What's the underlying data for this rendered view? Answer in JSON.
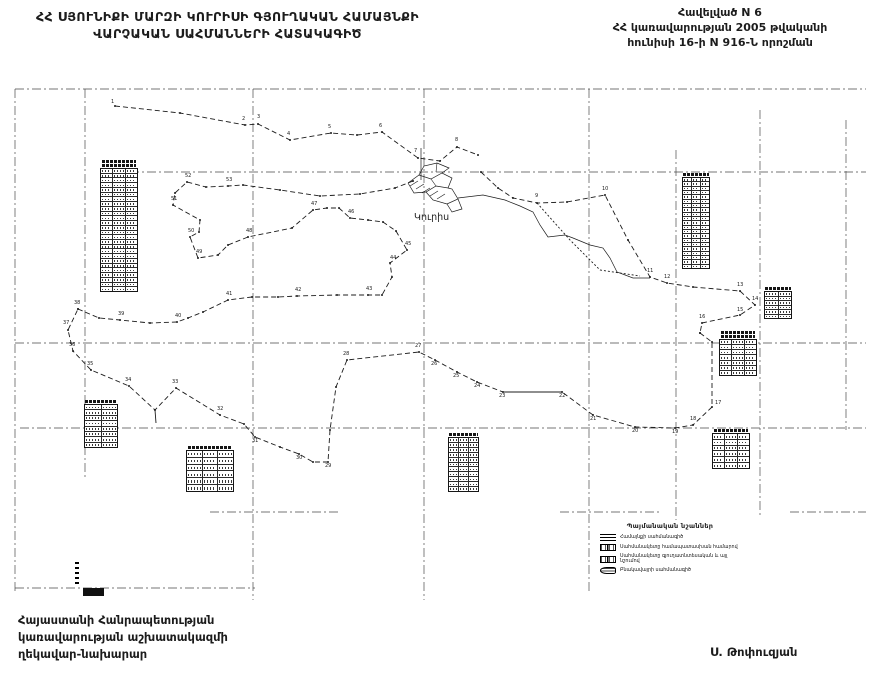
{
  "header": {
    "title_line1": "ՀՀ ՍՅՈՒՆԻՔԻ ՄԱՐԶԻ ԿՈՒՐԻՍԻ ԳՅՈՒՂԱԿԱՆ ՀԱՄԱՅՆՔԻ",
    "title_line2": "ՎԱՐՉԱԿԱՆ ՍԱՀՄԱՆՆԵՐԻ ՀԱՏԱԿԱԳԻԾ",
    "appendix_line1": "Հավելված N 6",
    "appendix_line2": "ՀՀ կառավարության 2005 թվականի",
    "appendix_line3": "հունիսի 16-ի N 916-Ն որոշման"
  },
  "footer": {
    "left_line1": "Հայաստանի Հանրապետության",
    "left_line2": "կառավարության աշխատակազմի",
    "left_line3": "ղեկավար-նախարար",
    "signature": "Ս. Թոփուզյան"
  },
  "legend": {
    "title": "Պայմանական նշաններ",
    "items": [
      {
        "symbol": "community-boundary-line-symbol",
        "label": "Համայնքի սահմանագիծ"
      },
      {
        "symbol": "boundary-point-number-symbol",
        "label": "Սահմանակետը համապատասխան համարով"
      },
      {
        "symbol": "boundary-point-agri-symbol",
        "label": "Սահմանակետը գյուղատնտեսական և այլ նշումով"
      },
      {
        "symbol": "settlement-boundary-symbol",
        "label": "Բնակավայրի սահմանագիծ"
      }
    ]
  },
  "map": {
    "settlement_label": "Կուրիս",
    "colors": {
      "ink": "#1c1c1c",
      "grid": "#4a4a4a",
      "paper": "#ffffff"
    },
    "grid": {
      "h": [
        {
          "y": 89,
          "x1": 15,
          "x2": 866
        },
        {
          "y": 172,
          "x1": 130,
          "x2": 866
        },
        {
          "y": 343,
          "x1": 15,
          "x2": 866
        },
        {
          "y": 428,
          "x1": 20,
          "x2": 866
        },
        {
          "y": 512,
          "x1": 210,
          "x2": 340
        },
        {
          "y": 512,
          "x1": 560,
          "x2": 660
        },
        {
          "y": 512,
          "x1": 790,
          "x2": 866
        },
        {
          "y": 588,
          "x1": 15,
          "x2": 255
        }
      ],
      "v": [
        {
          "x": 15,
          "y1": 89,
          "y2": 592
        },
        {
          "x": 85,
          "y1": 89,
          "y2": 480
        },
        {
          "x": 253,
          "y1": 89,
          "y2": 600
        },
        {
          "x": 424,
          "y1": 89,
          "y2": 600
        },
        {
          "x": 589,
          "y1": 89,
          "y2": 592
        },
        {
          "x": 676,
          "y1": 150,
          "y2": 520
        },
        {
          "x": 760,
          "y1": 110,
          "y2": 515
        },
        {
          "x": 846,
          "y1": 120,
          "y2": 430
        }
      ]
    },
    "paths": [
      {
        "name": "north-boundary",
        "dash": "5 3",
        "marks": true,
        "pts": [
          [
            115,
            106
          ],
          [
            180,
            113
          ],
          [
            245,
            125
          ],
          [
            258,
            124
          ],
          [
            290,
            140
          ],
          [
            331,
            133
          ],
          [
            357,
            135
          ],
          [
            382,
            132
          ],
          [
            418,
            158
          ],
          [
            440,
            161
          ],
          [
            457,
            147
          ],
          [
            478,
            155
          ]
        ]
      },
      {
        "name": "northeast-boundary",
        "dash": "5 3",
        "marks": true,
        "pts": [
          [
            481,
            172
          ],
          [
            498,
            188
          ],
          [
            513,
            198
          ],
          [
            537,
            203
          ],
          [
            567,
            202
          ],
          [
            605,
            195
          ],
          [
            628,
            240
          ],
          [
            650,
            277
          ],
          [
            667,
            283
          ],
          [
            693,
            287
          ],
          [
            740,
            291
          ],
          [
            755,
            305
          ],
          [
            740,
            315
          ],
          [
            702,
            323
          ],
          [
            700,
            333
          ]
        ]
      },
      {
        "name": "stream-line",
        "solid": true,
        "w": 0.7,
        "pts": [
          [
            458,
            198
          ],
          [
            483,
            195
          ],
          [
            505,
            200
          ],
          [
            520,
            206
          ],
          [
            533,
            212
          ],
          [
            540,
            225
          ],
          [
            548,
            237
          ],
          [
            565,
            235
          ],
          [
            573,
            238
          ],
          [
            590,
            245
          ],
          [
            603,
            248
          ],
          [
            610,
            258
          ],
          [
            617,
            272
          ],
          [
            633,
            278
          ],
          [
            650,
            278
          ]
        ]
      },
      {
        "name": "secondary-dashed-line",
        "dash": "2 2",
        "pts": [
          [
            537,
            203
          ],
          [
            570,
            240
          ],
          [
            600,
            270
          ],
          [
            640,
            276
          ]
        ]
      },
      {
        "name": "east-south-boundary",
        "dash": "5 3",
        "marks": true,
        "pts": [
          [
            700,
            333
          ],
          [
            712,
            342
          ],
          [
            712,
            407
          ],
          [
            693,
            425
          ],
          [
            675,
            428
          ],
          [
            635,
            427
          ],
          [
            593,
            415
          ],
          [
            562,
            392
          ],
          [
            503,
            392
          ],
          [
            477,
            382
          ],
          [
            457,
            372
          ],
          [
            435,
            360
          ],
          [
            419,
            352
          ],
          [
            347,
            360
          ],
          [
            336,
            387
          ],
          [
            330,
            430
          ],
          [
            328,
            462
          ],
          [
            313,
            462
          ],
          [
            299,
            454
          ],
          [
            280,
            447
          ],
          [
            255,
            437
          ],
          [
            244,
            424
          ],
          [
            220,
            415
          ],
          [
            176,
            388
          ],
          [
            155,
            410
          ],
          [
            129,
            386
          ],
          [
            91,
            370
          ],
          [
            73,
            351
          ],
          [
            68,
            330
          ],
          [
            78,
            309
          ]
        ]
      },
      {
        "name": "solid-boundary-segment",
        "solid": true,
        "pts": [
          [
            503,
            392
          ],
          [
            562,
            392
          ]
        ]
      },
      {
        "name": "middle-boundary",
        "dash": "5 3",
        "marks": true,
        "pts": [
          [
            78,
            309
          ],
          [
            99,
            318
          ],
          [
            120,
            320
          ],
          [
            150,
            323
          ],
          [
            177,
            322
          ],
          [
            188,
            318
          ],
          [
            203,
            312
          ],
          [
            228,
            300
          ],
          [
            252,
            297
          ],
          [
            278,
            297
          ],
          [
            297,
            296
          ],
          [
            337,
            295
          ],
          [
            368,
            295
          ],
          [
            382,
            295
          ],
          [
            392,
            277
          ],
          [
            390,
            263
          ],
          [
            407,
            250
          ],
          [
            396,
            231
          ],
          [
            383,
            222
          ],
          [
            368,
            220
          ],
          [
            350,
            218
          ],
          [
            339,
            208
          ],
          [
            327,
            208
          ],
          [
            313,
            210
          ],
          [
            292,
            228
          ],
          [
            248,
            237
          ],
          [
            228,
            245
          ],
          [
            218,
            255
          ],
          [
            198,
            258
          ],
          [
            190,
            237
          ],
          [
            199,
            232
          ],
          [
            200,
            220
          ],
          [
            173,
            205
          ],
          [
            175,
            193
          ],
          [
            187,
            182
          ],
          [
            206,
            187
          ],
          [
            228,
            186
          ],
          [
            243,
            185
          ],
          [
            280,
            190
          ],
          [
            320,
            196
          ],
          [
            360,
            194
          ],
          [
            395,
            188
          ],
          [
            413,
            181
          ]
        ]
      },
      {
        "name": "dip-tick",
        "solid": true,
        "pts": [
          [
            155,
            410
          ],
          [
            156,
            423
          ]
        ]
      },
      {
        "name": "settlement-block-a",
        "solid": true,
        "w": 0.7,
        "pts": [
          [
            408,
            183
          ],
          [
            419,
            175
          ],
          [
            431,
            179
          ],
          [
            442,
            173
          ],
          [
            452,
            178
          ],
          [
            448,
            188
          ],
          [
            436,
            186
          ],
          [
            426,
            192
          ],
          [
            414,
            193
          ],
          [
            408,
            183
          ]
        ]
      },
      {
        "name": "settlement-block-b",
        "solid": true,
        "w": 0.7,
        "pts": [
          [
            419,
            175
          ],
          [
            424,
            166
          ],
          [
            437,
            163
          ],
          [
            449,
            168
          ],
          [
            442,
            173
          ]
        ]
      },
      {
        "name": "settlement-block-c",
        "solid": true,
        "w": 0.7,
        "pts": [
          [
            426,
            192
          ],
          [
            433,
            200
          ],
          [
            447,
            204
          ],
          [
            458,
            199
          ],
          [
            452,
            189
          ],
          [
            448,
            188
          ]
        ]
      },
      {
        "name": "settlement-block-d",
        "solid": true,
        "w": 0.7,
        "pts": [
          [
            447,
            204
          ],
          [
            452,
            212
          ],
          [
            462,
            209
          ],
          [
            458,
            199
          ]
        ]
      },
      {
        "name": "settlement-hatch",
        "solid": true,
        "w": 0.6,
        "pts": [
          [
            410,
            186
          ],
          [
            418,
            181
          ]
        ]
      },
      {
        "name": "settlement-hatch",
        "solid": true,
        "w": 0.6,
        "pts": [
          [
            416,
            189
          ],
          [
            424,
            184
          ]
        ]
      },
      {
        "name": "settlement-hatch",
        "solid": true,
        "w": 0.6,
        "pts": [
          [
            422,
            193
          ],
          [
            430,
            188
          ]
        ]
      },
      {
        "name": "settlement-hatch",
        "solid": true,
        "w": 0.6,
        "pts": [
          [
            430,
            196
          ],
          [
            438,
            191
          ]
        ]
      },
      {
        "name": "settlement-hatch",
        "solid": true,
        "w": 0.6,
        "pts": [
          [
            437,
            199
          ],
          [
            445,
            194
          ]
        ]
      },
      {
        "name": "settlement-hatch",
        "solid": true,
        "w": 0.6,
        "pts": [
          [
            431,
            179
          ],
          [
            436,
            186
          ]
        ]
      },
      {
        "name": "settlement-hatch",
        "solid": true,
        "w": 0.6,
        "pts": [
          [
            437,
            163
          ],
          [
            436,
            172
          ]
        ]
      },
      {
        "name": "settlement-mast",
        "solid": true,
        "w": 0.7,
        "pts": [
          [
            421,
            148
          ],
          [
            421,
            180
          ]
        ]
      }
    ],
    "point_labels": [
      {
        "t": "1",
        "x": 111,
        "y": 103
      },
      {
        "t": "2",
        "x": 242,
        "y": 120
      },
      {
        "t": "3",
        "x": 257,
        "y": 118
      },
      {
        "t": "4",
        "x": 287,
        "y": 135
      },
      {
        "t": "5",
        "x": 328,
        "y": 128
      },
      {
        "t": "6",
        "x": 379,
        "y": 127
      },
      {
        "t": "7",
        "x": 414,
        "y": 152
      },
      {
        "t": "8",
        "x": 455,
        "y": 141
      },
      {
        "t": "9",
        "x": 535,
        "y": 197
      },
      {
        "t": "10",
        "x": 602,
        "y": 190
      },
      {
        "t": "11",
        "x": 647,
        "y": 272
      },
      {
        "t": "12",
        "x": 664,
        "y": 278
      },
      {
        "t": "13",
        "x": 737,
        "y": 286
      },
      {
        "t": "14",
        "x": 752,
        "y": 300
      },
      {
        "t": "15",
        "x": 737,
        "y": 311
      },
      {
        "t": "16",
        "x": 699,
        "y": 318
      },
      {
        "t": "17",
        "x": 715,
        "y": 404
      },
      {
        "t": "18",
        "x": 690,
        "y": 420
      },
      {
        "t": "19",
        "x": 672,
        "y": 433
      },
      {
        "t": "20",
        "x": 632,
        "y": 432
      },
      {
        "t": "21",
        "x": 590,
        "y": 420
      },
      {
        "t": "22",
        "x": 559,
        "y": 397
      },
      {
        "t": "23",
        "x": 499,
        "y": 397
      },
      {
        "t": "24",
        "x": 474,
        "y": 387
      },
      {
        "t": "25",
        "x": 453,
        "y": 377
      },
      {
        "t": "26",
        "x": 431,
        "y": 365
      },
      {
        "t": "27",
        "x": 415,
        "y": 347
      },
      {
        "t": "28",
        "x": 343,
        "y": 355
      },
      {
        "t": "29",
        "x": 325,
        "y": 467
      },
      {
        "t": "30",
        "x": 296,
        "y": 459
      },
      {
        "t": "31",
        "x": 252,
        "y": 442
      },
      {
        "t": "32",
        "x": 217,
        "y": 410
      },
      {
        "t": "33",
        "x": 172,
        "y": 383
      },
      {
        "t": "34",
        "x": 125,
        "y": 381
      },
      {
        "t": "35",
        "x": 87,
        "y": 365
      },
      {
        "t": "36",
        "x": 69,
        "y": 346
      },
      {
        "t": "37",
        "x": 63,
        "y": 324
      },
      {
        "t": "38",
        "x": 74,
        "y": 304
      },
      {
        "t": "39",
        "x": 118,
        "y": 315
      },
      {
        "t": "40",
        "x": 175,
        "y": 317
      },
      {
        "t": "41",
        "x": 226,
        "y": 295
      },
      {
        "t": "42",
        "x": 295,
        "y": 291
      },
      {
        "t": "43",
        "x": 366,
        "y": 290
      },
      {
        "t": "44",
        "x": 390,
        "y": 259
      },
      {
        "t": "45",
        "x": 405,
        "y": 245
      },
      {
        "t": "46",
        "x": 348,
        "y": 213
      },
      {
        "t": "47",
        "x": 311,
        "y": 205
      },
      {
        "t": "48",
        "x": 246,
        "y": 232
      },
      {
        "t": "49",
        "x": 196,
        "y": 253
      },
      {
        "t": "50",
        "x": 188,
        "y": 232
      },
      {
        "t": "51",
        "x": 171,
        "y": 200
      },
      {
        "t": "52",
        "x": 185,
        "y": 177
      },
      {
        "t": "53",
        "x": 226,
        "y": 181
      }
    ],
    "tables": [
      {
        "x": 100,
        "y": 160,
        "w": 38,
        "h": 130,
        "rows": 26,
        "cols": 3,
        "titles": 2
      },
      {
        "x": 682,
        "y": 173,
        "w": 28,
        "h": 94,
        "rows": 21,
        "cols": 3,
        "titles": 1
      },
      {
        "x": 764,
        "y": 287,
        "w": 28,
        "h": 30,
        "rows": 6,
        "cols": 2,
        "titles": 1
      },
      {
        "x": 719,
        "y": 331,
        "w": 38,
        "h": 43,
        "rows": 7,
        "cols": 3,
        "titles": 2
      },
      {
        "x": 84,
        "y": 400,
        "w": 34,
        "h": 46,
        "rows": 8,
        "cols": 2,
        "titles": 1
      },
      {
        "x": 186,
        "y": 446,
        "w": 48,
        "h": 44,
        "rows": 6,
        "cols": 3,
        "titles": 1
      },
      {
        "x": 448,
        "y": 433,
        "w": 31,
        "h": 57,
        "rows": 11,
        "cols": 3,
        "titles": 1
      },
      {
        "x": 712,
        "y": 429,
        "w": 38,
        "h": 38,
        "rows": 6,
        "cols": 3,
        "titles": 1
      }
    ]
  }
}
